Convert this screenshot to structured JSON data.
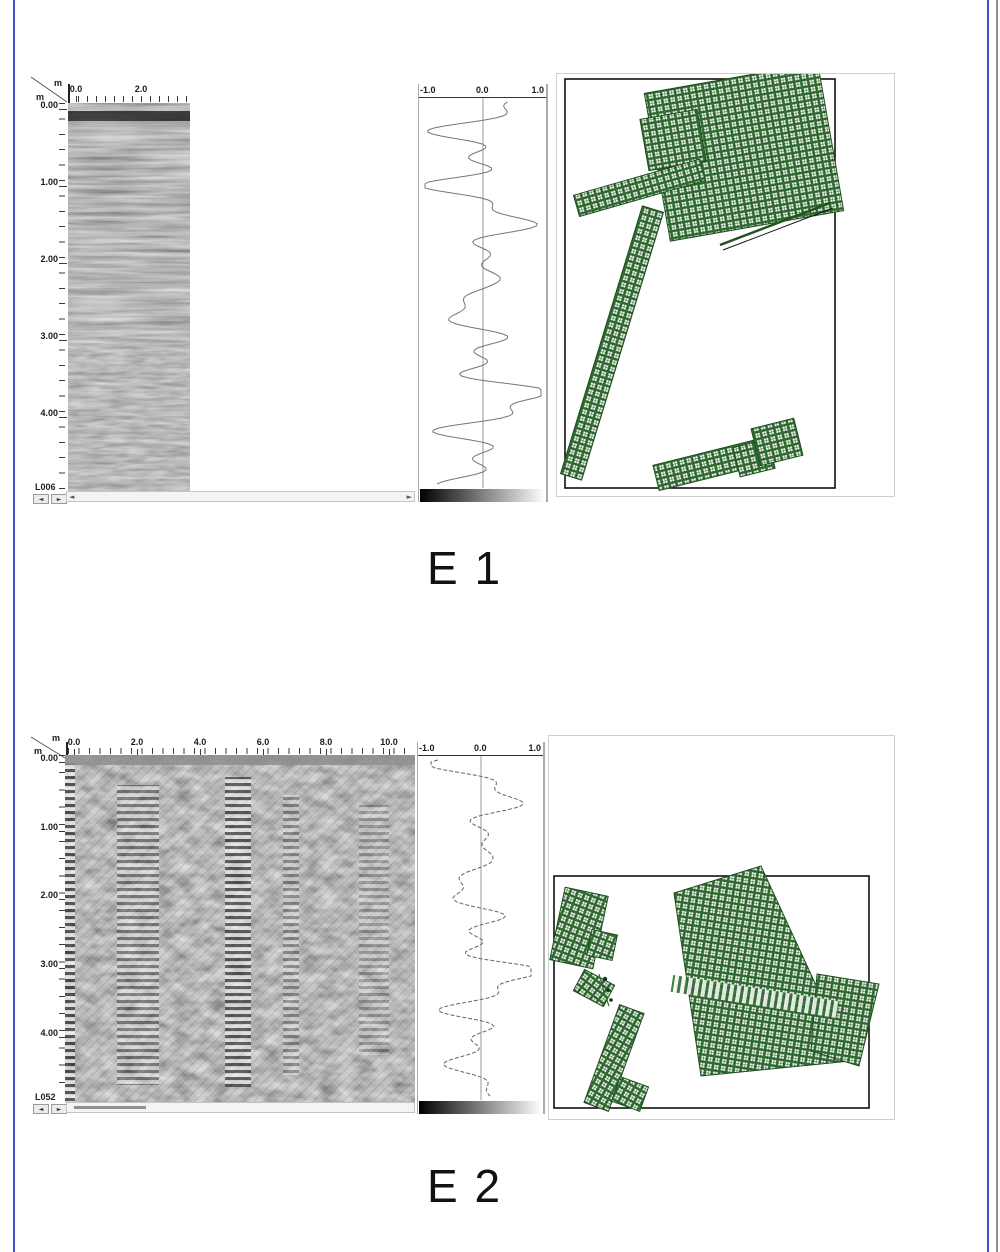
{
  "colors": {
    "grid_green": "#2e6b2e",
    "grid_green_dark": "#1d4d1d",
    "rule_blue": "#4a4ac8",
    "edge_gray": "#909090",
    "caption_color": "#111111"
  },
  "figures": [
    {
      "caption": "E 1",
      "radargram": {
        "top_unit": "m",
        "left_unit": "m",
        "top_labels": [
          "0.0",
          "2.0"
        ],
        "left_labels": [
          "0.00",
          "1.00",
          "2.00",
          "3.00",
          "4.00"
        ],
        "line_label": "L006"
      },
      "trace": {
        "axis_labels": [
          "-1.0",
          "0.0",
          "1.0"
        ]
      },
      "scrollbar": {
        "left_arrow": "◄",
        "right_arrow": "►"
      },
      "nav": {
        "left": "◄",
        "right": "►"
      }
    },
    {
      "caption": "E 2",
      "radargram": {
        "top_unit": "m",
        "left_unit": "m",
        "top_labels": [
          "0.0",
          "2.0",
          "4.0",
          "6.0",
          "8.0",
          "10.0"
        ],
        "left_labels": [
          "0.00",
          "1.00",
          "2.00",
          "3.00",
          "4.00"
        ],
        "line_label": "L052"
      },
      "trace": {
        "axis_labels": [
          "-1.0",
          "0.0",
          "1.0"
        ]
      },
      "scrollbar": {
        "left_arrow": "◄",
        "right_arrow": "►"
      },
      "nav": {
        "left": "◄",
        "right": "►"
      }
    }
  ]
}
